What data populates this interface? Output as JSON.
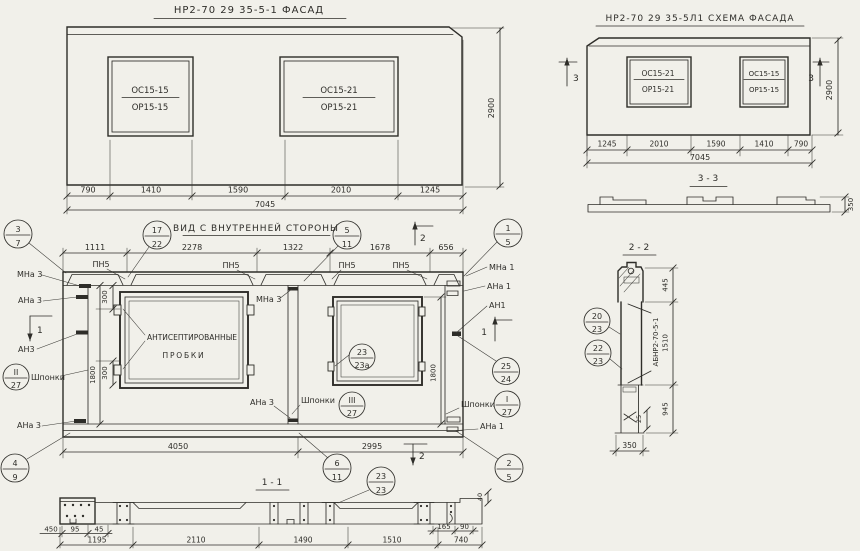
{
  "facade": {
    "title": "НР2-70 29 35-5-1 ФАСАД",
    "win_left_top": "ОС15-15",
    "win_left_bot": "ОР15-15",
    "win_right_top": "ОС15-21",
    "win_right_bot": "ОР15-21",
    "d1": "790",
    "d2": "1410",
    "d3": "1590",
    "d4": "2010",
    "d5": "1245",
    "total": "7045",
    "height": "2900"
  },
  "schema": {
    "title": "НР2-70 29 35-5Л1 СХЕМА ФАСАДА",
    "win_left_top": "ОС15-21",
    "win_left_bot": "ОР15-21",
    "win_right_top": "ОС15-15",
    "win_right_bot": "ОР15-15",
    "d1": "1245",
    "d2": "2010",
    "d3": "1590",
    "d4": "1410",
    "d5": "790",
    "total": "7045",
    "height": "2900",
    "mark": "3"
  },
  "section33": {
    "title": "3 - 3",
    "height": "350"
  },
  "inner": {
    "title": "ВИД С ВНУТРЕННЕЙ СТОРОНЫ",
    "d1": "1111",
    "d2": "2278",
    "d3": "1322",
    "d4": "1678",
    "d5": "656",
    "pn5": "ПН5",
    "mna3": "МНа 3",
    "ana3": "АНа 3",
    "an3": "АН3",
    "mna1": "МНа 1",
    "ana1": "АНа 1",
    "an1": "АН1",
    "shponki": "Шпонки",
    "plugs1": "АНТИСЕПТИРОВАННЫЕ",
    "plugs2": "ПРОБКИ",
    "v300": "300",
    "v1800": "1800",
    "d4050": "4050",
    "d2995": "2995",
    "mark1": "1",
    "mark2": "2",
    "c37": {
      "t": "3",
      "b": "7"
    },
    "c1722": {
      "t": "17",
      "b": "22"
    },
    "c511": {
      "t": "5",
      "b": "11"
    },
    "c15": {
      "t": "1",
      "b": "5"
    },
    "c227": {
      "t": "II",
      "b": "27"
    },
    "c2323a": {
      "t": "23",
      "b": "23а"
    },
    "c2524": {
      "t": "25",
      "b": "24"
    },
    "c327": {
      "t": "III",
      "b": "27"
    },
    "c127": {
      "t": "I",
      "b": "27"
    },
    "c49": {
      "t": "4",
      "b": "9"
    },
    "c611": {
      "t": "6",
      "b": "11"
    },
    "c25": {
      "t": "2",
      "b": "5"
    },
    "c2323": {
      "t": "23",
      "b": "23"
    }
  },
  "section11": {
    "title": "1 - 1",
    "d450": "450",
    "d95": "95",
    "d45": "45",
    "d1195": "1195",
    "d2110": "2110",
    "d1490": "1490",
    "d1510": "1510",
    "d740": "740",
    "d165": "165",
    "d90": "90",
    "d40": "40"
  },
  "section22": {
    "title": "2 - 2",
    "label": "АБНР2-70-5-1",
    "c2023": {
      "t": "20",
      "b": "23"
    },
    "c2223": {
      "t": "22",
      "b": "23"
    },
    "d445": "445",
    "d1510": "1510",
    "d945": "945",
    "d25": "25",
    "d350": "350"
  }
}
